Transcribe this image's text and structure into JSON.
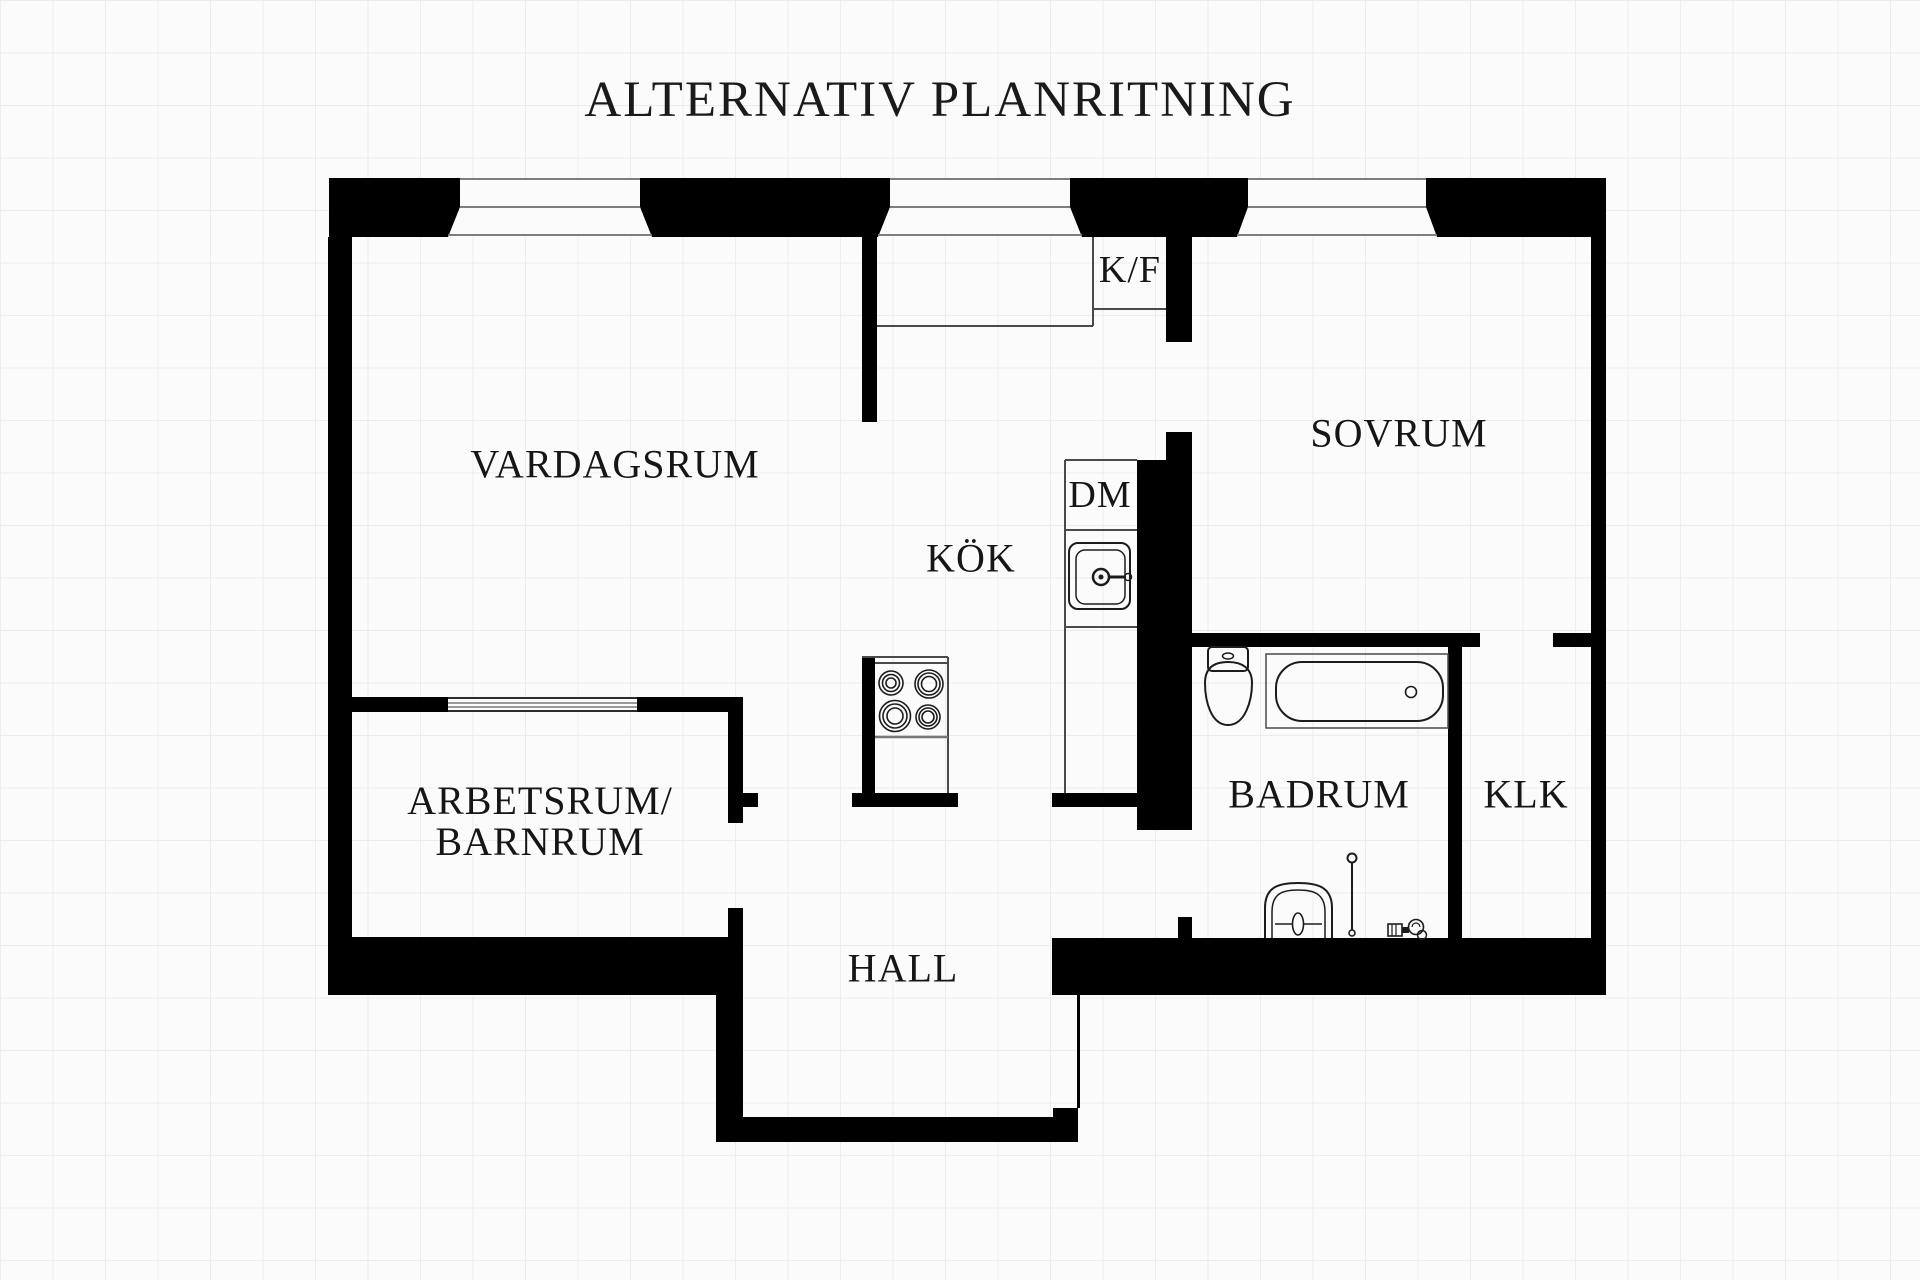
{
  "title": "ALTERNATIV PLANRITNING",
  "rooms": {
    "vardagsrum": {
      "label": "VARDAGSRUM"
    },
    "kok": {
      "label": "KÖK"
    },
    "sovrum": {
      "label": "SOVRUM"
    },
    "badrum": {
      "label": "BADRUM"
    },
    "klk": {
      "label": "KLK"
    },
    "hall": {
      "label": "HALL"
    },
    "arbetsrum": {
      "label_line1": "ARBETSRUM/",
      "label_line2": "BARNRUM"
    }
  },
  "appliances": {
    "fridge_freezer": "K/F",
    "dishwasher": "DM"
  },
  "colors": {
    "wall": "#000000",
    "background": "#fbfbfb",
    "grid_line": "#ececec",
    "window_sill": "#7d7d7d",
    "fixture_line": "#1c1c1c"
  }
}
